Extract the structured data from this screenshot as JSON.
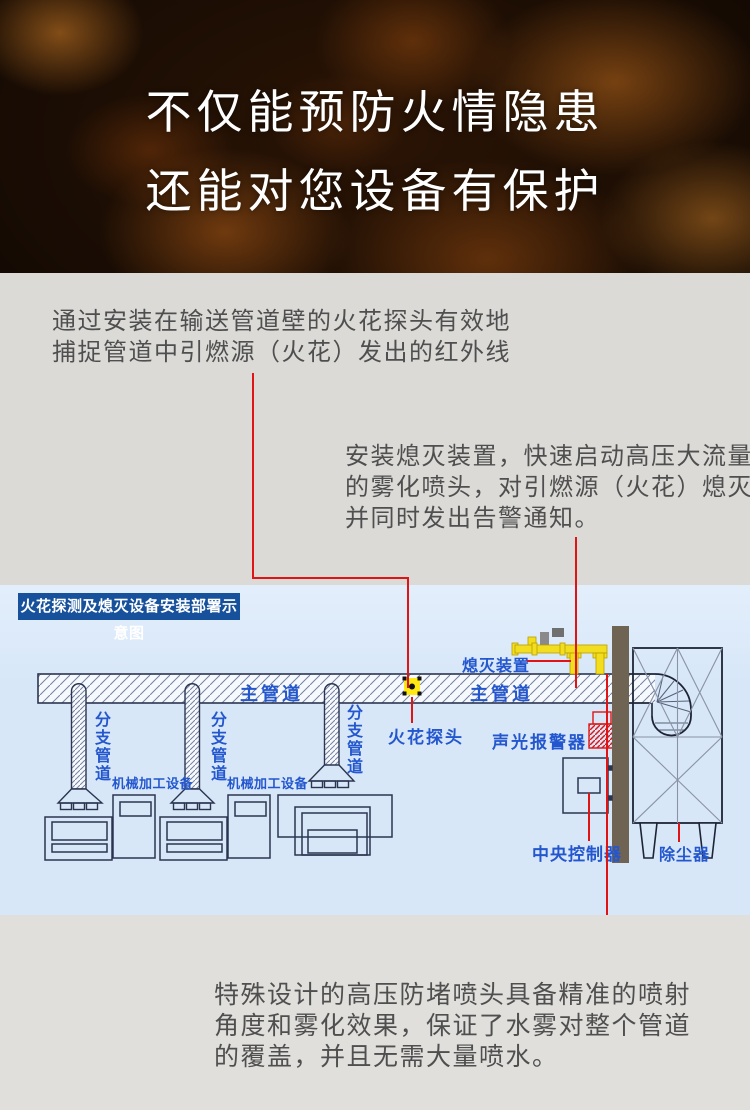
{
  "banner": {
    "line1": "不仅能预防火情隐患",
    "line2": "还能对您设备有保护"
  },
  "paragraphs": {
    "p1": {
      "lines": [
        "通过安装在输送管道壁的火花探头有效地",
        "捕捉管道中引燃源（火花）发出的红外线"
      ]
    },
    "p2": {
      "lines": [
        "安装熄灭装置，快速启动高压大流量",
        "的雾化喷头，对引燃源（火花）熄灭",
        "并同时发出告警通知。"
      ]
    },
    "p3": {
      "lines": [
        "特殊设计的高压防堵喷头具备精准的喷射",
        "角度和雾化效果，保证了水雾对整个管道",
        "的覆盖，并且无需大量喷水。"
      ]
    }
  },
  "diagram": {
    "title": "火花探测及熄灭设备安装部署示意图",
    "labels": {
      "main_pipe_left": "主管道",
      "main_pipe_right": "主管道",
      "branch_pipe_1": "分支管道",
      "branch_pipe_2": "分支管道",
      "branch_pipe_3": "分支管道",
      "machine_1": "机械加工设备",
      "machine_2": "机械加工设备",
      "spark_detector": "火花探头",
      "extinguisher": "熄灭装置",
      "alarm": "声光报警器",
      "controller": "中央控制器",
      "dust_collector": "除尘器"
    },
    "colors": {
      "background": "#d7e7f8",
      "title_badge": "#17519c",
      "label_blue": "#2457ce",
      "outline_navy": "#2b3550",
      "connector_red": "#e01414",
      "device_yellow": "#f2de1e",
      "wall_brown": "#6f6453"
    }
  }
}
